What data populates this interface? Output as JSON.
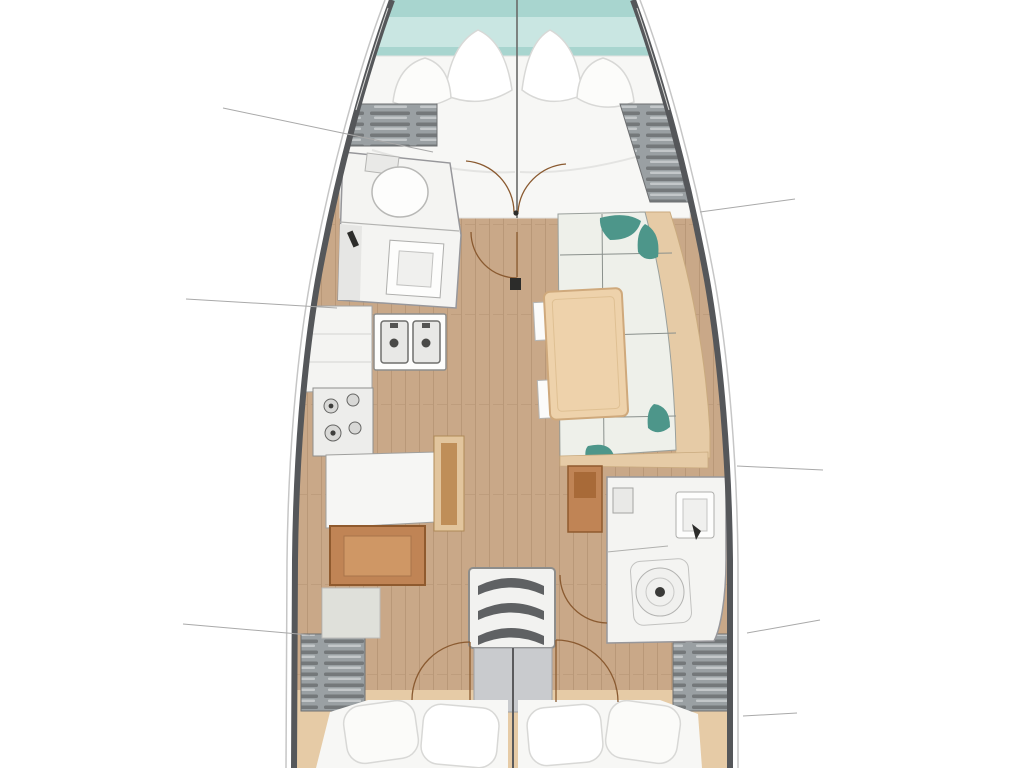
{
  "diagram": {
    "type": "sailboat-interior-floor-plan",
    "view": "top-down, bow at top",
    "visible_text": "",
    "areas": [
      "bow-water",
      "v-berth-cabin",
      "forward-head",
      "galley",
      "nav-seat",
      "salon-settee",
      "salon-table",
      "aft-head",
      "companionway-stairs",
      "aft-cabin-port",
      "aft-cabin-starboard",
      "side-deck-lockers"
    ],
    "callout_line_count": 7
  },
  "palette": {
    "bg": "#ffffff",
    "hull": "#55575a",
    "hull-outer": "#c6c6c6",
    "deck-seam": "#dadad8",
    "water": "#a8d5cf",
    "water-light": "#c9e6e2",
    "floor": "#c9a888",
    "locker-base": "#9aa0a3",
    "locker-dark": "#74787a",
    "locker-light": "#c3c7c9",
    "room-white": "#f4f4f2",
    "room-stroke": "#97979b",
    "fixture-white": "#fdfdfc",
    "fixture-stroke": "#aeaeac",
    "cushion": "#eef0ea",
    "cushion-line": "#8a908c",
    "teal": "#4d968a",
    "wood-trim": "#e6cba6",
    "wood-trim-stroke": "#c9aa7e",
    "table-wood": "#eed2ab",
    "table-stroke": "#cfa97c",
    "seat-brown": "#c08455",
    "seat-brown-dark": "#8f5a2e",
    "seat-brown-light": "#cf9765",
    "stair-tread": "#5f6163",
    "platform": "#c9cbce",
    "platform-stroke": "#9fa1a4",
    "door-arc": "#8a5a30",
    "callout": "#a9a9a9",
    "mark-dark": "#2c2c2a",
    "bed-white": "#f7f7f5",
    "pillow-stroke": "#d8d8d6"
  }
}
